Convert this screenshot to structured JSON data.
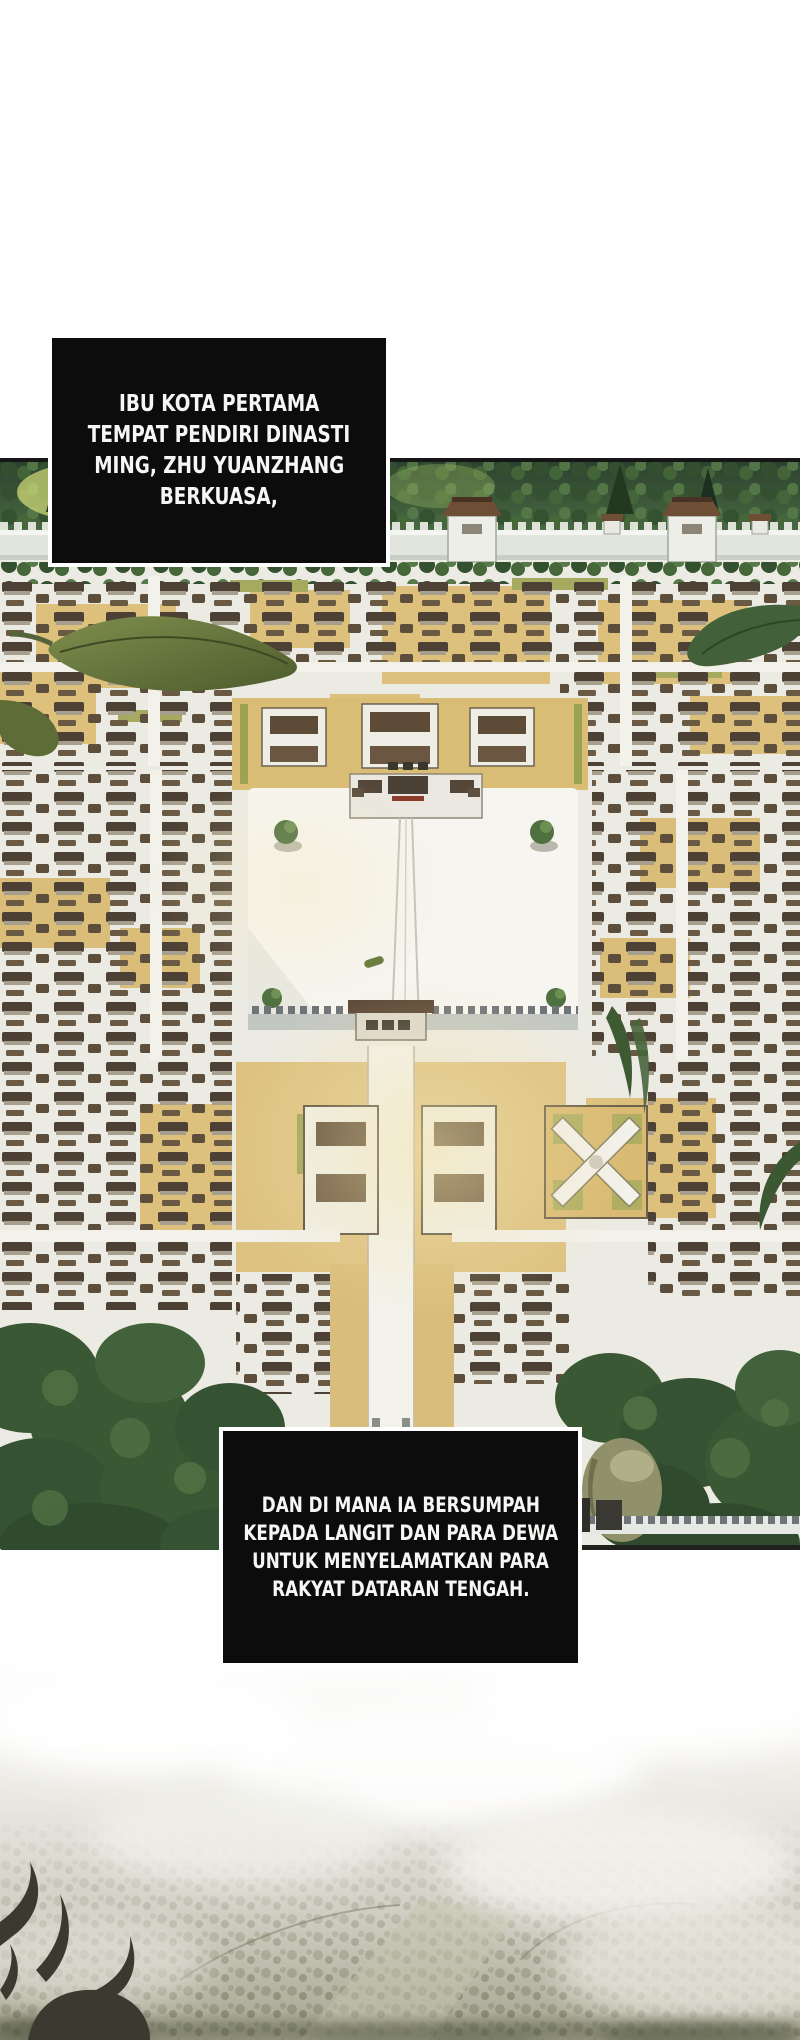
{
  "page": {
    "background": "#ffffff",
    "kind": "manhwa-comic-page"
  },
  "captions": {
    "top": {
      "lines": [
        "IBU KOTA PERTAMA",
        "TEMPAT PENDIRI DINASTI",
        "MING, ZHU YUANZHANG",
        "BERKUASA,"
      ],
      "bg": "#0c0c0c",
      "text_color": "#f6f6f4",
      "border_color": "#ffffff"
    },
    "bottom": {
      "lines": [
        "DAN DI MANA IA BERSUMPAH",
        "KEPADA LANGIT DAN PARA DEWA",
        "UNTUK MENYELAMATKAN PARA",
        "RAKYAT DATARAN TENGAH."
      ],
      "bg": "#0c0c0c",
      "text_color": "#f6f6f4",
      "border_color": "#ffffff"
    }
  },
  "artwork": {
    "city_panel_label": "aerial-view-ming-capital",
    "mist_panel_label": "mist-over-valley",
    "palette": {
      "forest_green": "#3a5834",
      "roof_brown": "#5a4a38",
      "courtyard_tan": "#dcc07c",
      "ground_light": "#ecebe3",
      "wall_gray": "#e2e5de",
      "mist_gray": "#c9c8bc",
      "silhouette_dark": "#3b3a31"
    }
  }
}
